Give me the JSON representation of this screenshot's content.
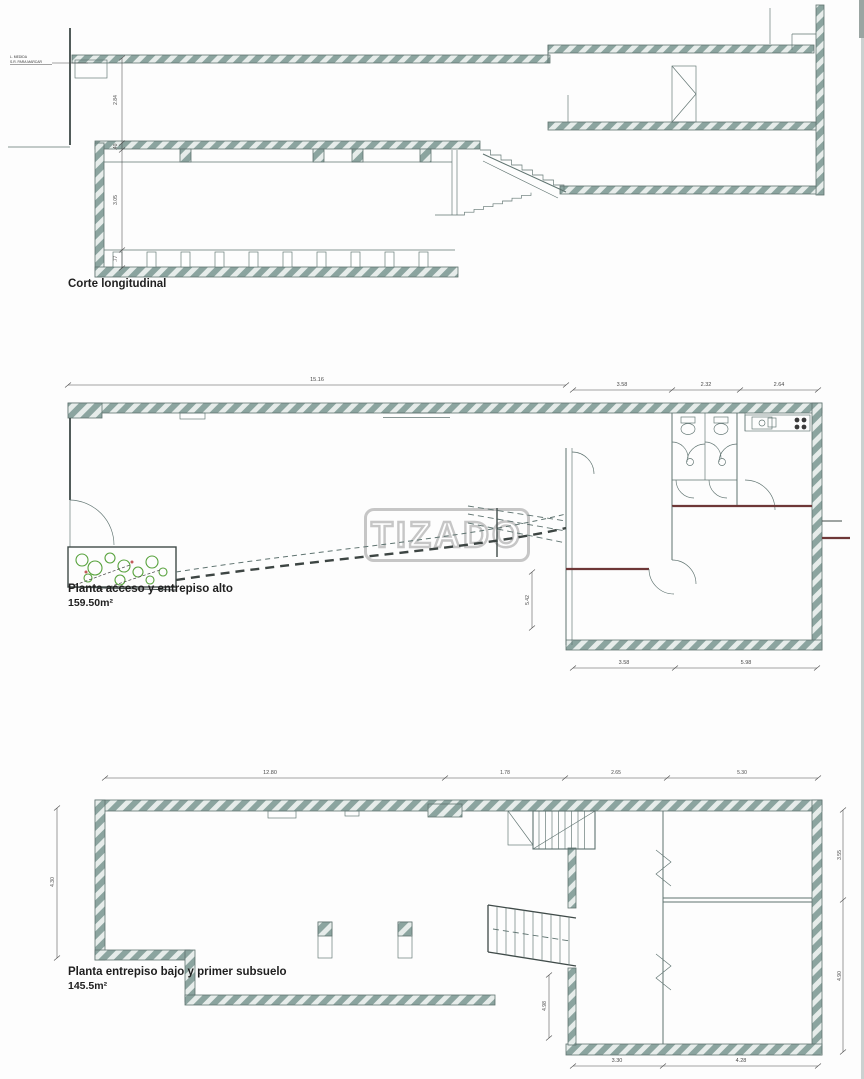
{
  "watermark": "TIZADO",
  "colors": {
    "hatch_dark": "#8ba49f",
    "hatch_light": "#e6ecea",
    "line": "#5f7370",
    "dim": "#4a4a4a",
    "text": "#1f1f1f",
    "maroon": "#6e3737",
    "plant": "#57a23c",
    "wm": "#c2c2c2"
  },
  "views": {
    "section": {
      "title": "Corte longitudinal",
      "note1": "L. MEDIDA",
      "note2": "S.R. PARA MARCAR",
      "dims": {
        "v1": "2.84",
        "v2": ".40",
        "v3": "3.05",
        "v4": ".77"
      }
    },
    "plan_upper": {
      "title": "Planta acceso y entrepiso alto",
      "area": "159.50m²",
      "dims": {
        "top_main": "15.16",
        "top_1": "3.58",
        "top_2": "2.32",
        "top_3": "2.64",
        "bottom_1": "3.58",
        "bottom_2": "5.98",
        "right_v": "5.42"
      }
    },
    "plan_lower": {
      "title": "Planta entrepiso bajo y primer subsuelo",
      "area": "145.5m²",
      "dims": {
        "top_main": "12.80",
        "top_1": "1.78",
        "top_2": "2.65",
        "top_3": "5.30",
        "left_v": "4.30",
        "right_v1": "3.55",
        "right_v2": "4.90",
        "bottom_1": "3.30",
        "bottom_2": "4.28",
        "inner_v": "4.98"
      }
    }
  }
}
